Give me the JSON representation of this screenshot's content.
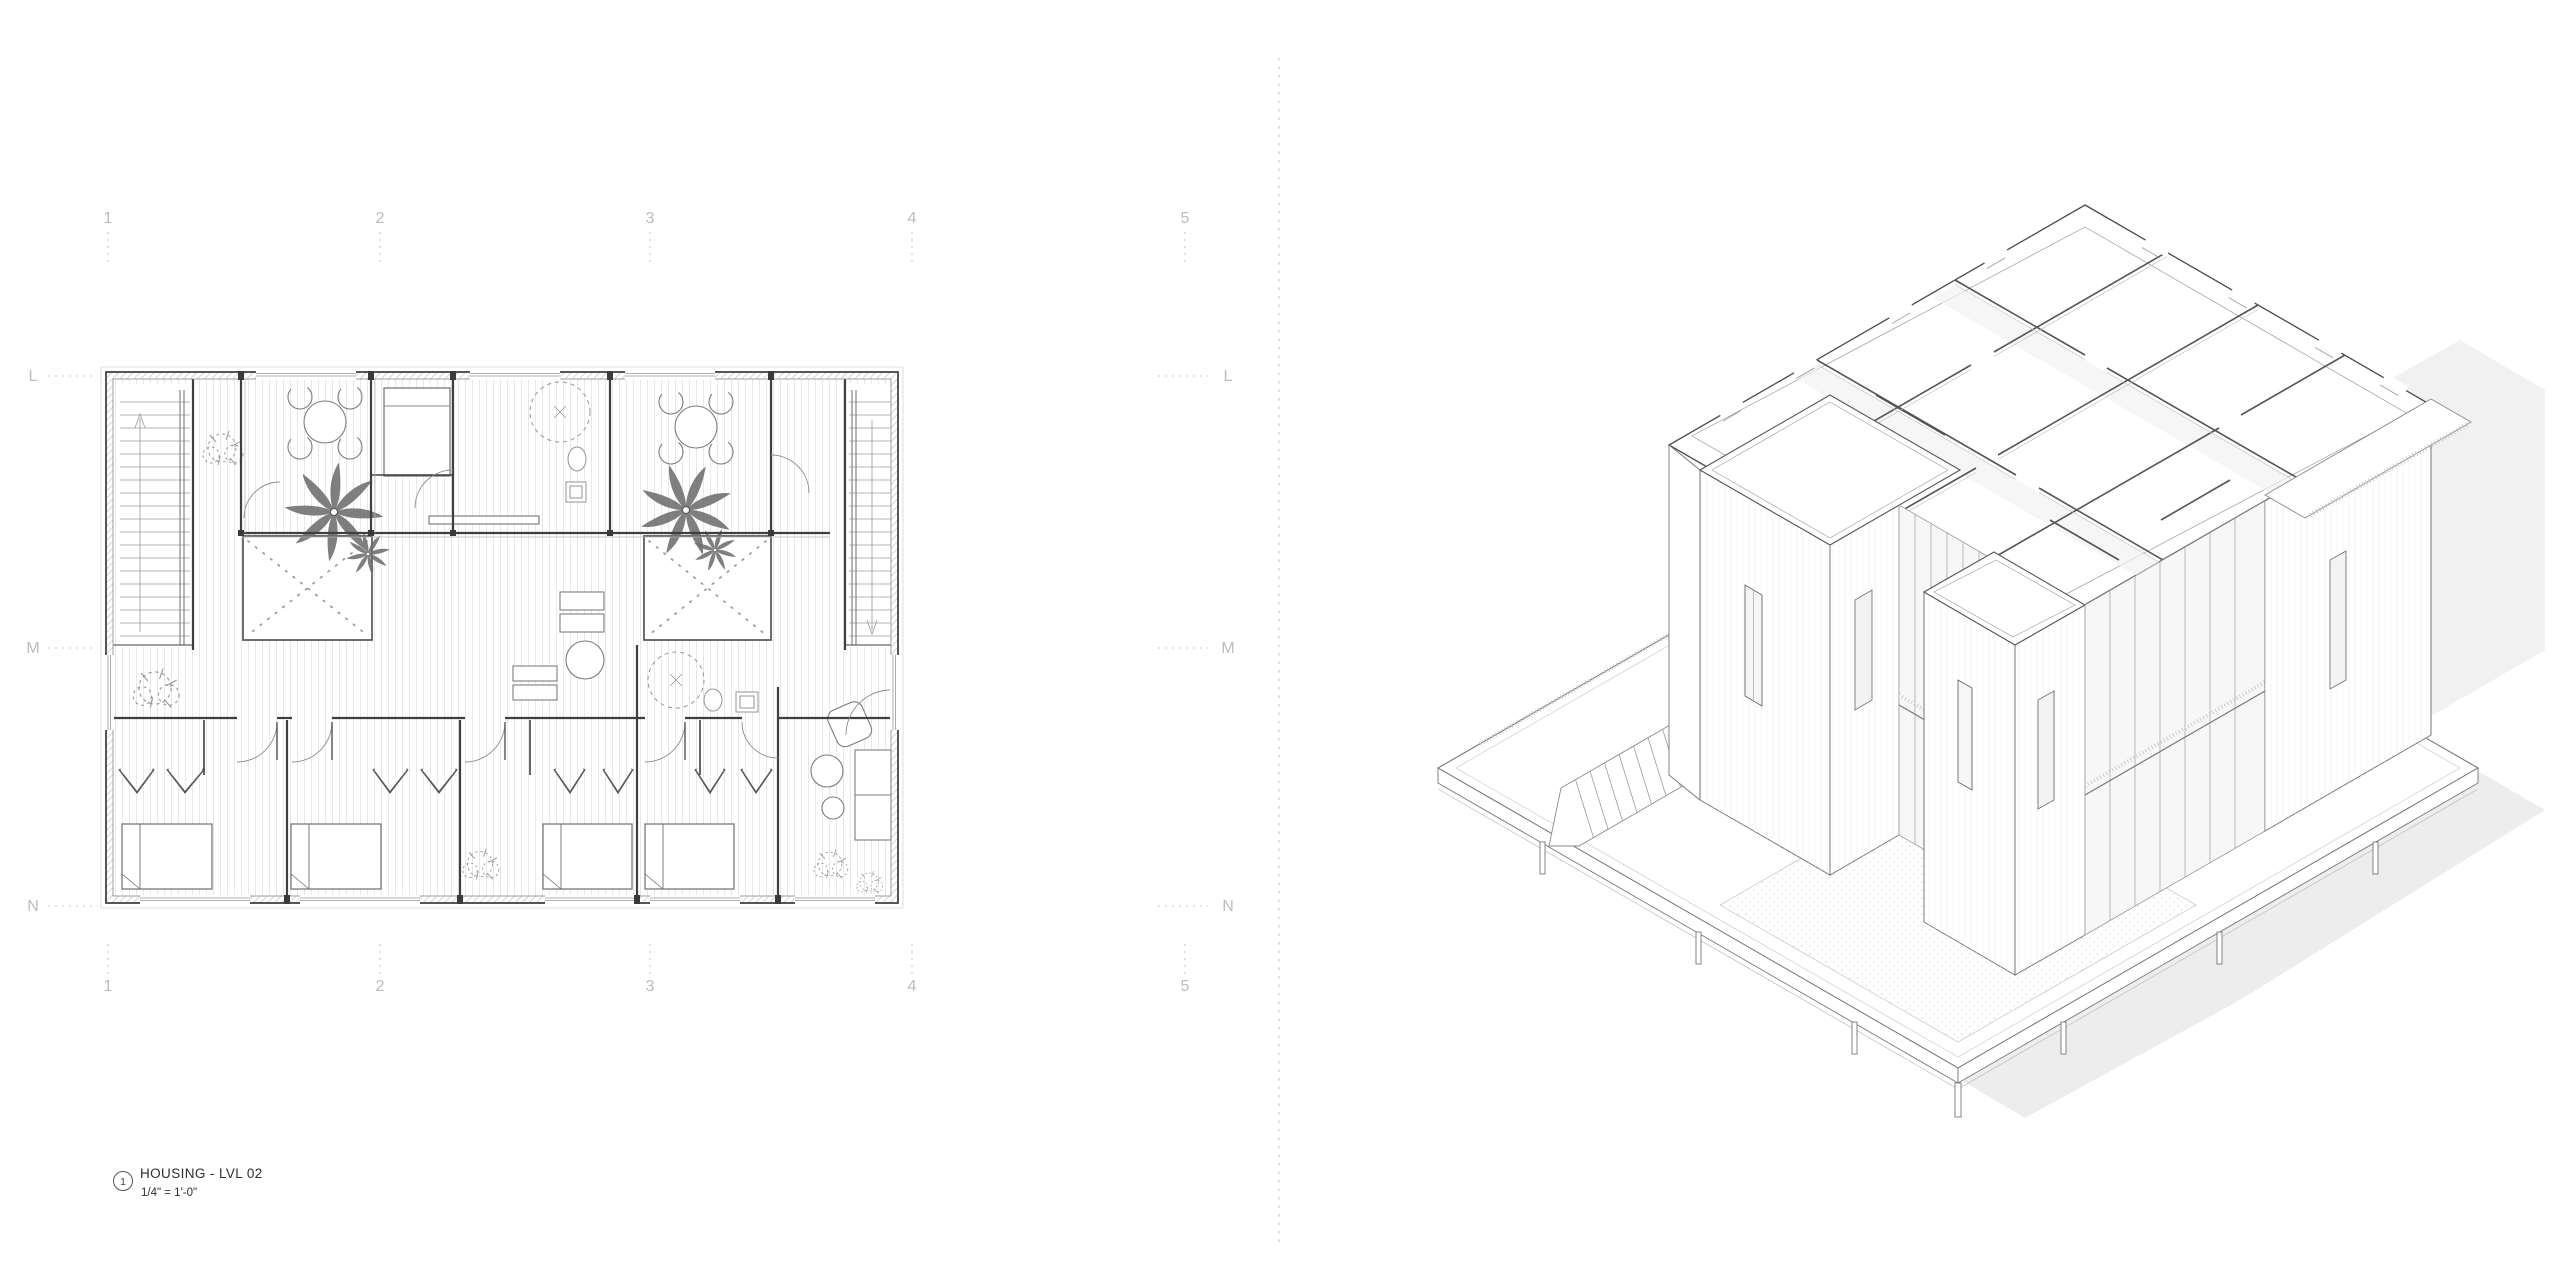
{
  "drawing_title": {
    "detail_number": "1",
    "name": "HOUSING - LVL 02",
    "scale": "1/4\" = 1'-0\""
  },
  "grid": {
    "columns_top": [
      "1",
      "2",
      "3",
      "4",
      "5"
    ],
    "columns_bottom": [
      "1",
      "2",
      "3",
      "4",
      "5"
    ],
    "rows_left": [
      "L",
      "M",
      "N"
    ],
    "rows_right": [
      "L",
      "M",
      "N"
    ]
  },
  "colors": {
    "background": "#ffffff",
    "cut_wall_line": "#3f3f3f",
    "light_line": "#8f8f8f",
    "plank_line": "#e7e7e7",
    "grid_label": "#bcbcbc",
    "shadow": "#ededed"
  }
}
